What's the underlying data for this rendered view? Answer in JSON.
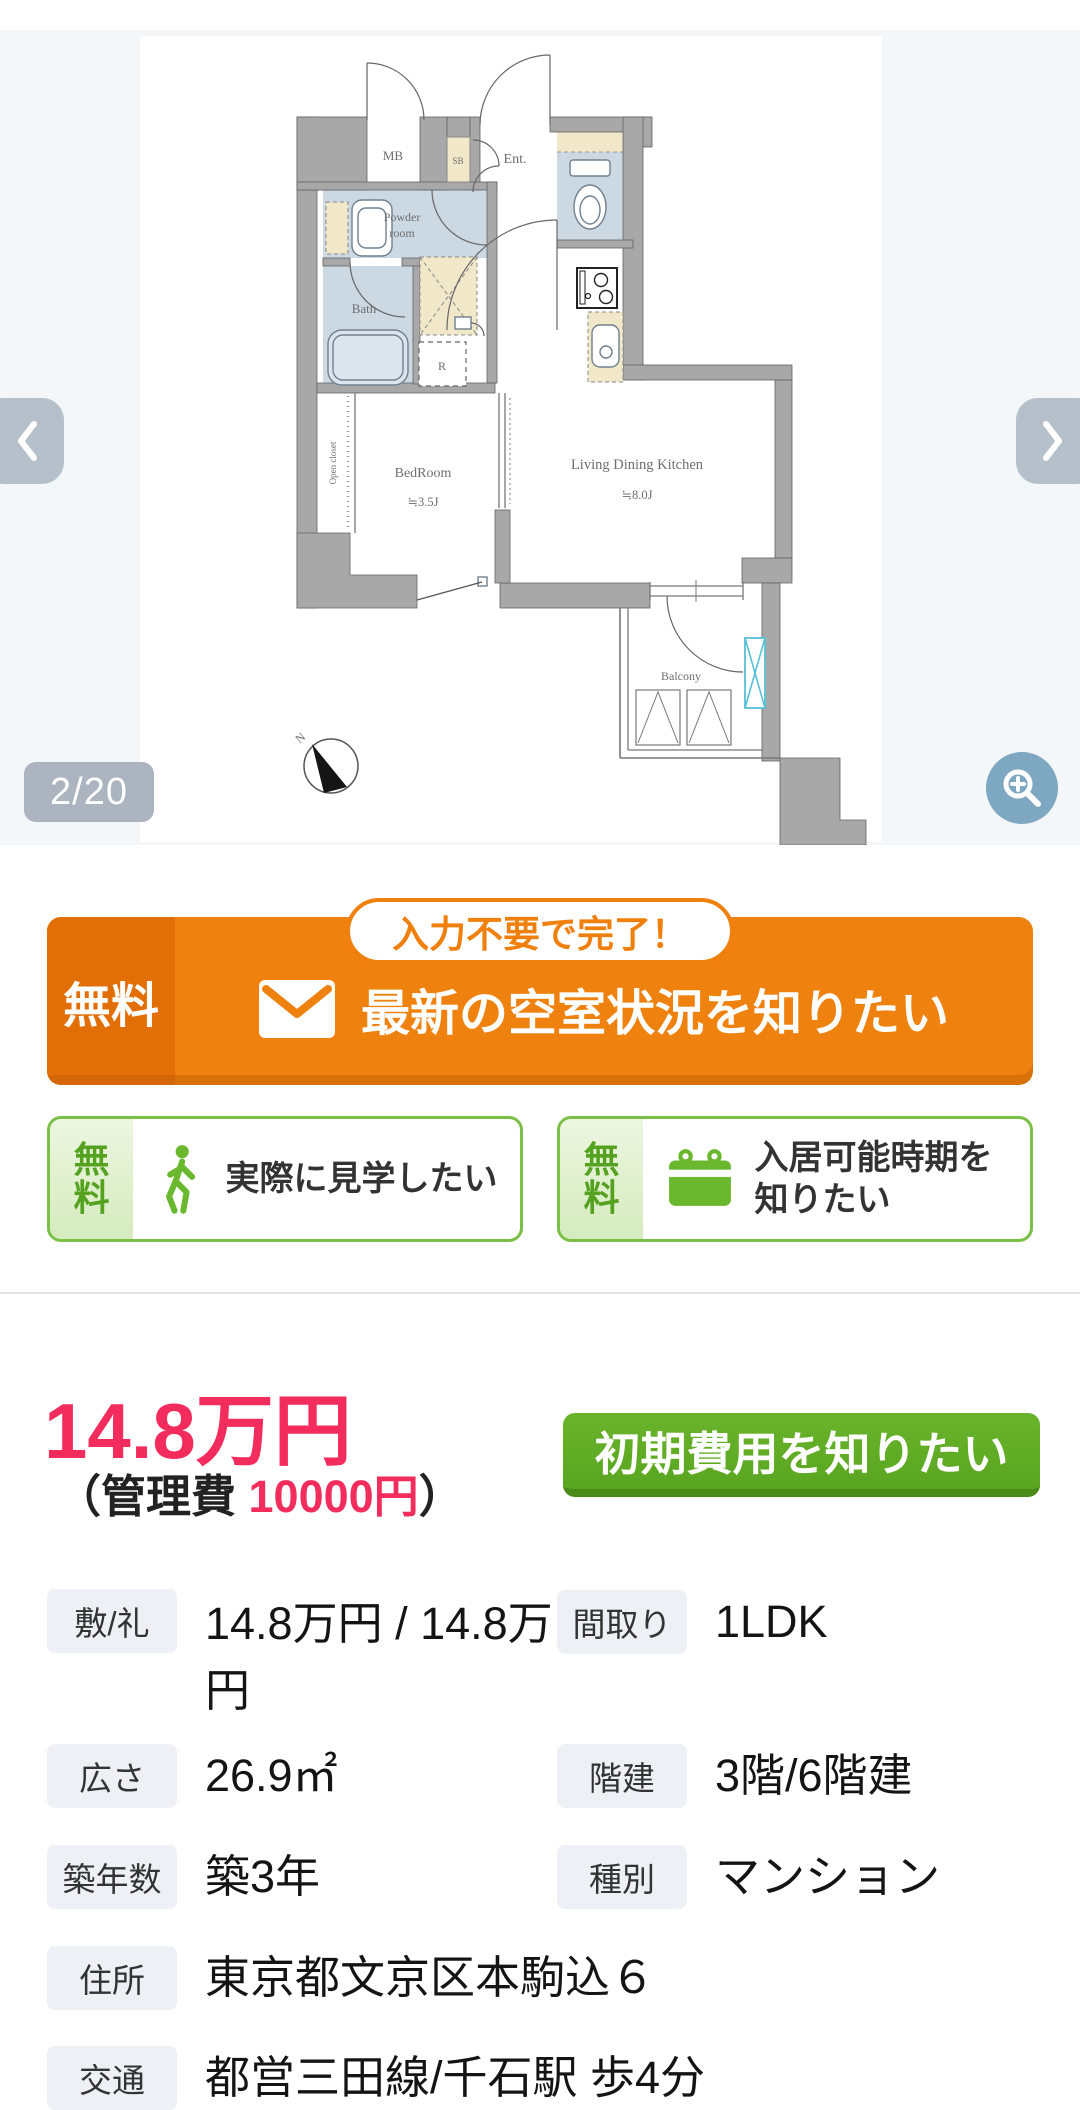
{
  "gallery": {
    "counter": "2/20",
    "floorplan": {
      "mb": "MB",
      "sb": "SB",
      "entrance": "Ent.",
      "powder_line1": "Powder",
      "powder_line2": "room",
      "bath": "Bath",
      "refrigerator": "R",
      "bedroom": "BedRoom",
      "bedroom_size": "≒3.5J",
      "ldk": "Living Dining Kitchen",
      "ldk_size": "≒8.0J",
      "open_closet": "Open closet",
      "balcony": "Balcony",
      "compass_north": "N"
    }
  },
  "cta_banner": {
    "ribbon": "入力不要で完了！",
    "free_label": "無料",
    "label": "最新の空室状況を知りたい"
  },
  "sub_ctas": [
    {
      "free_label": "無料",
      "label": "実際に見学したい",
      "icon": "walking-person-icon"
    },
    {
      "free_label": "無料",
      "label": "入居可能時期を知りたい",
      "icon": "calendar-icon"
    }
  ],
  "price_section": {
    "rent": "14.8万円",
    "management_open": "（管理費 ",
    "management_fee": "10000円",
    "management_close": "）",
    "initial_cost_button": "初期費用を知りたい"
  },
  "details": {
    "rows": [
      {
        "label": "敷/礼",
        "value": "14.8万円 / 14.8万円"
      },
      {
        "label": "間取り",
        "value": "1LDK"
      },
      {
        "label": "広さ",
        "value": "26.9㎡"
      },
      {
        "label": "階建",
        "value": "3階/6階建"
      },
      {
        "label": "築年数",
        "value": "築3年"
      },
      {
        "label": "種別",
        "value": "マンション"
      },
      {
        "label": "住所",
        "value": "東京都文京区本駒込６"
      },
      {
        "label": "交通",
        "value": "都営三田線/千石駅 歩4分"
      }
    ]
  },
  "colors": {
    "accent_orange": "#ef820e",
    "accent_green": "#5aa520",
    "price_pink": "#f32c5e"
  }
}
